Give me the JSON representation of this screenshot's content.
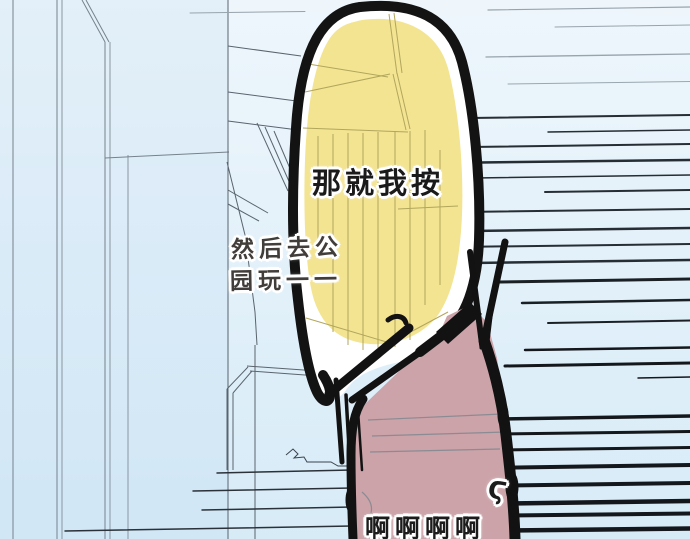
{
  "panel": {
    "dialogue": {
      "main": "那就我按",
      "aside_line1": "然后去公",
      "aside_line2": "园玩一一",
      "scream": "啊啊啊啊",
      "breath_mark": "Ϛ"
    },
    "colors": {
      "background_top": "#eef6fc",
      "background_bottom": "#d7ebf7",
      "finger_yellow": "#f3e492",
      "finger_rim": "#ffffff",
      "ink_outline": "#131313",
      "window_reflection": "#b1a65c",
      "person_pink": "#cba3a9",
      "speed_line_light": "#97a4ac",
      "speed_line_dark": "#14171b",
      "building_line": "#59646e",
      "main_text": "#1a1a1a",
      "aside_text": "#413d3a"
    }
  }
}
